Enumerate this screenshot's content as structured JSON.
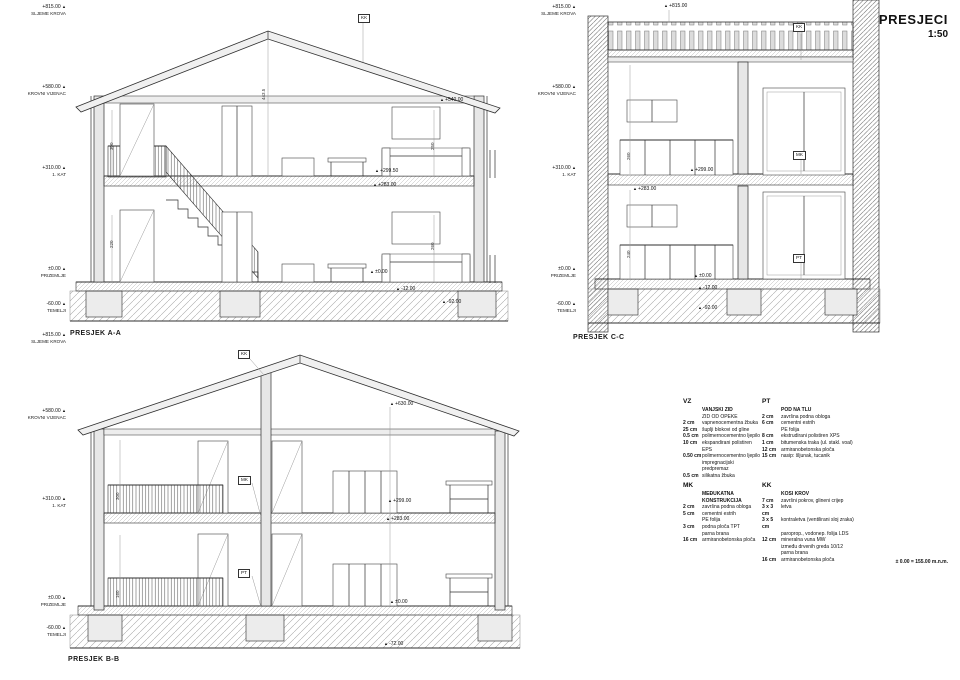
{
  "title": {
    "main": "PRESJECI",
    "scale": "1:50"
  },
  "sections": {
    "aa": {
      "label": "PRESJEK A-A"
    },
    "bb": {
      "label": "PRESJEK B-B"
    },
    "cc": {
      "label": "PRESJEK C-C"
    }
  },
  "levels": [
    {
      "x": 66,
      "y": 4,
      "value": "+815.00",
      "name": "SLJEME KROVA"
    },
    {
      "x": 66,
      "y": 84,
      "value": "+580.00",
      "name": "KROVNI VIJENAC"
    },
    {
      "x": 66,
      "y": 165,
      "value": "+310.00",
      "name": "1. KAT"
    },
    {
      "x": 66,
      "y": 266,
      "value": "±0.00",
      "name": "PRIZEMLJE"
    },
    {
      "x": 66,
      "y": 301,
      "value": "-60.00",
      "name": "TEMELJI"
    },
    {
      "x": 66,
      "y": 332,
      "value": "+815.00",
      "name": "SLJEME KROVA"
    },
    {
      "x": 66,
      "y": 408,
      "value": "+580.00",
      "name": "KROVNI VIJENAC"
    },
    {
      "x": 66,
      "y": 496,
      "value": "+310.00",
      "name": "1. KAT"
    },
    {
      "x": 66,
      "y": 595,
      "value": "±0.00",
      "name": "PRIZEMLJE"
    },
    {
      "x": 66,
      "y": 625,
      "value": "-60.00",
      "name": "TEMELJI"
    },
    {
      "x": 576,
      "y": 4,
      "value": "+815.00",
      "name": "SLJEME KROVA"
    },
    {
      "x": 576,
      "y": 84,
      "value": "+580.00",
      "name": "KROVNI VIJENAC"
    },
    {
      "x": 576,
      "y": 165,
      "value": "+310.00",
      "name": "1. KAT"
    },
    {
      "x": 576,
      "y": 266,
      "value": "±0.00",
      "name": "PRIZEMLJE"
    },
    {
      "x": 576,
      "y": 301,
      "value": "-60.00",
      "name": "TEMELJI"
    }
  ],
  "markers": [
    {
      "x": 358,
      "y": 14,
      "text": "KK",
      "kind": "box"
    },
    {
      "x": 440,
      "y": 97,
      "text": "+540.00",
      "kind": "elev"
    },
    {
      "x": 375,
      "y": 168,
      "text": "+299.50",
      "kind": "elev"
    },
    {
      "x": 373,
      "y": 182,
      "text": "+283.00",
      "kind": "elev"
    },
    {
      "x": 370,
      "y": 269,
      "text": "±0.00",
      "kind": "elev"
    },
    {
      "x": 396,
      "y": 286,
      "text": "-12.00",
      "kind": "elev"
    },
    {
      "x": 442,
      "y": 299,
      "text": "-92.00",
      "kind": "elev"
    },
    {
      "x": 261,
      "y": 100,
      "text": "443.5",
      "kind": "dim"
    },
    {
      "x": 109,
      "y": 150,
      "text": "300",
      "kind": "dim"
    },
    {
      "x": 109,
      "y": 248,
      "text": "220",
      "kind": "dim"
    },
    {
      "x": 430,
      "y": 150,
      "text": "250",
      "kind": "dim"
    },
    {
      "x": 430,
      "y": 250,
      "text": "260",
      "kind": "dim"
    },
    {
      "x": 793,
      "y": 23,
      "text": "KK",
      "kind": "box"
    },
    {
      "x": 793,
      "y": 151,
      "text": "MK",
      "kind": "box"
    },
    {
      "x": 793,
      "y": 254,
      "text": "PT",
      "kind": "box"
    },
    {
      "x": 664,
      "y": 3,
      "text": "+815.00",
      "kind": "elev"
    },
    {
      "x": 690,
      "y": 167,
      "text": "+299.00",
      "kind": "elev"
    },
    {
      "x": 633,
      "y": 186,
      "text": "+283.00",
      "kind": "elev"
    },
    {
      "x": 694,
      "y": 273,
      "text": "±0.00",
      "kind": "elev"
    },
    {
      "x": 698,
      "y": 285,
      "text": "-12.00",
      "kind": "elev"
    },
    {
      "x": 698,
      "y": 305,
      "text": "-92.00",
      "kind": "elev"
    },
    {
      "x": 626,
      "y": 160,
      "text": "260",
      "kind": "dim"
    },
    {
      "x": 626,
      "y": 258,
      "text": "240",
      "kind": "dim"
    },
    {
      "x": 238,
      "y": 350,
      "text": "KK",
      "kind": "box"
    },
    {
      "x": 238,
      "y": 476,
      "text": "MK",
      "kind": "box"
    },
    {
      "x": 238,
      "y": 569,
      "text": "PT",
      "kind": "box"
    },
    {
      "x": 390,
      "y": 401,
      "text": "+630.00",
      "kind": "elev"
    },
    {
      "x": 388,
      "y": 498,
      "text": "+299.00",
      "kind": "elev"
    },
    {
      "x": 386,
      "y": 516,
      "text": "+283.00",
      "kind": "elev"
    },
    {
      "x": 390,
      "y": 599,
      "text": "±0.00",
      "kind": "elev"
    },
    {
      "x": 384,
      "y": 641,
      "text": "-72.00",
      "kind": "elev"
    },
    {
      "x": 115,
      "y": 500,
      "text": "300",
      "kind": "dim"
    },
    {
      "x": 115,
      "y": 598,
      "text": "160",
      "kind": "dim"
    }
  ],
  "legend": {
    "groups": [
      {
        "code": "VZ",
        "rows": [
          {
            "q": "",
            "d": "VANJSKI ZID",
            "b": true
          },
          {
            "q": "",
            "d": "ZID OD OPEKE",
            "b": false
          },
          {
            "q": "2 cm",
            "d": "vapnenocementna žbuka",
            "b": false
          },
          {
            "q": "25 cm",
            "d": "šuplji blokovi od gline",
            "b": false
          },
          {
            "q": "0.5 cm",
            "d": "polimernocementno ljepilo",
            "b": false
          },
          {
            "q": "10 cm",
            "d": "ekspandirani polistiren EPS",
            "b": false
          },
          {
            "q": "0.50 cm",
            "d": "polimernocementno ljepilo",
            "b": false
          },
          {
            "q": "",
            "d": "impregnacijski predpremaz",
            "b": false
          },
          {
            "q": "0.5 cm",
            "d": "silikatna žbuka",
            "b": false
          }
        ]
      },
      {
        "code": "PT",
        "rows": [
          {
            "q": "",
            "d": "POD NA TLU",
            "b": true
          },
          {
            "q": "2 cm",
            "d": "završna podna obloga",
            "b": false
          },
          {
            "q": "6 cm",
            "d": "cementni estrih",
            "b": false
          },
          {
            "q": "",
            "d": "PE folija",
            "b": false
          },
          {
            "q": "8 cm",
            "d": "ekstrudirani polistiren XPS",
            "b": false
          },
          {
            "q": "1 cm",
            "d": "bitumenska traka (ul. stakl. voal)",
            "b": false
          },
          {
            "q": "12 cm",
            "d": "armiranobetonska ploča",
            "b": false
          },
          {
            "q": "15 cm",
            "d": "nasip: šljunak, tucanik",
            "b": false
          }
        ]
      },
      {
        "code": "MK",
        "rows": [
          {
            "q": "",
            "d": "MEĐUKATNA KONSTRUKCIJA",
            "b": true
          },
          {
            "q": "2 cm",
            "d": "završna podna obloga",
            "b": false
          },
          {
            "q": "5 cm",
            "d": "cementni estrih",
            "b": false
          },
          {
            "q": "",
            "d": "PE folija",
            "b": false
          },
          {
            "q": "3 cm",
            "d": "podna ploča TPT",
            "b": false
          },
          {
            "q": "",
            "d": "parna brana",
            "b": false
          },
          {
            "q": "16 cm",
            "d": "armiranobetonska ploča",
            "b": false
          }
        ]
      },
      {
        "code": "KK",
        "rows": [
          {
            "q": "",
            "d": "KOSI KROV",
            "b": true
          },
          {
            "q": "7 cm",
            "d": "završni pokrov, glineni crijep",
            "b": false
          },
          {
            "q": "3 x 3 cm",
            "d": "letva",
            "b": false
          },
          {
            "q": "3 x 5 cm",
            "d": "kontraletva (ventilirani sloj zraka)",
            "b": false
          },
          {
            "q": "",
            "d": "paroprop., vodonep. folija LDS",
            "b": false
          },
          {
            "q": "12 cm",
            "d": "mineralna vuna MW",
            "b": false
          },
          {
            "q": "",
            "d": "između drvenih greda 10/12",
            "b": false
          },
          {
            "q": "",
            "d": "parna brana",
            "b": false
          },
          {
            "q": "16 cm",
            "d": "armiranobetonska ploča",
            "b": false
          }
        ]
      }
    ]
  },
  "datum_note": "± 0.00 = 155.00 m.n.m."
}
